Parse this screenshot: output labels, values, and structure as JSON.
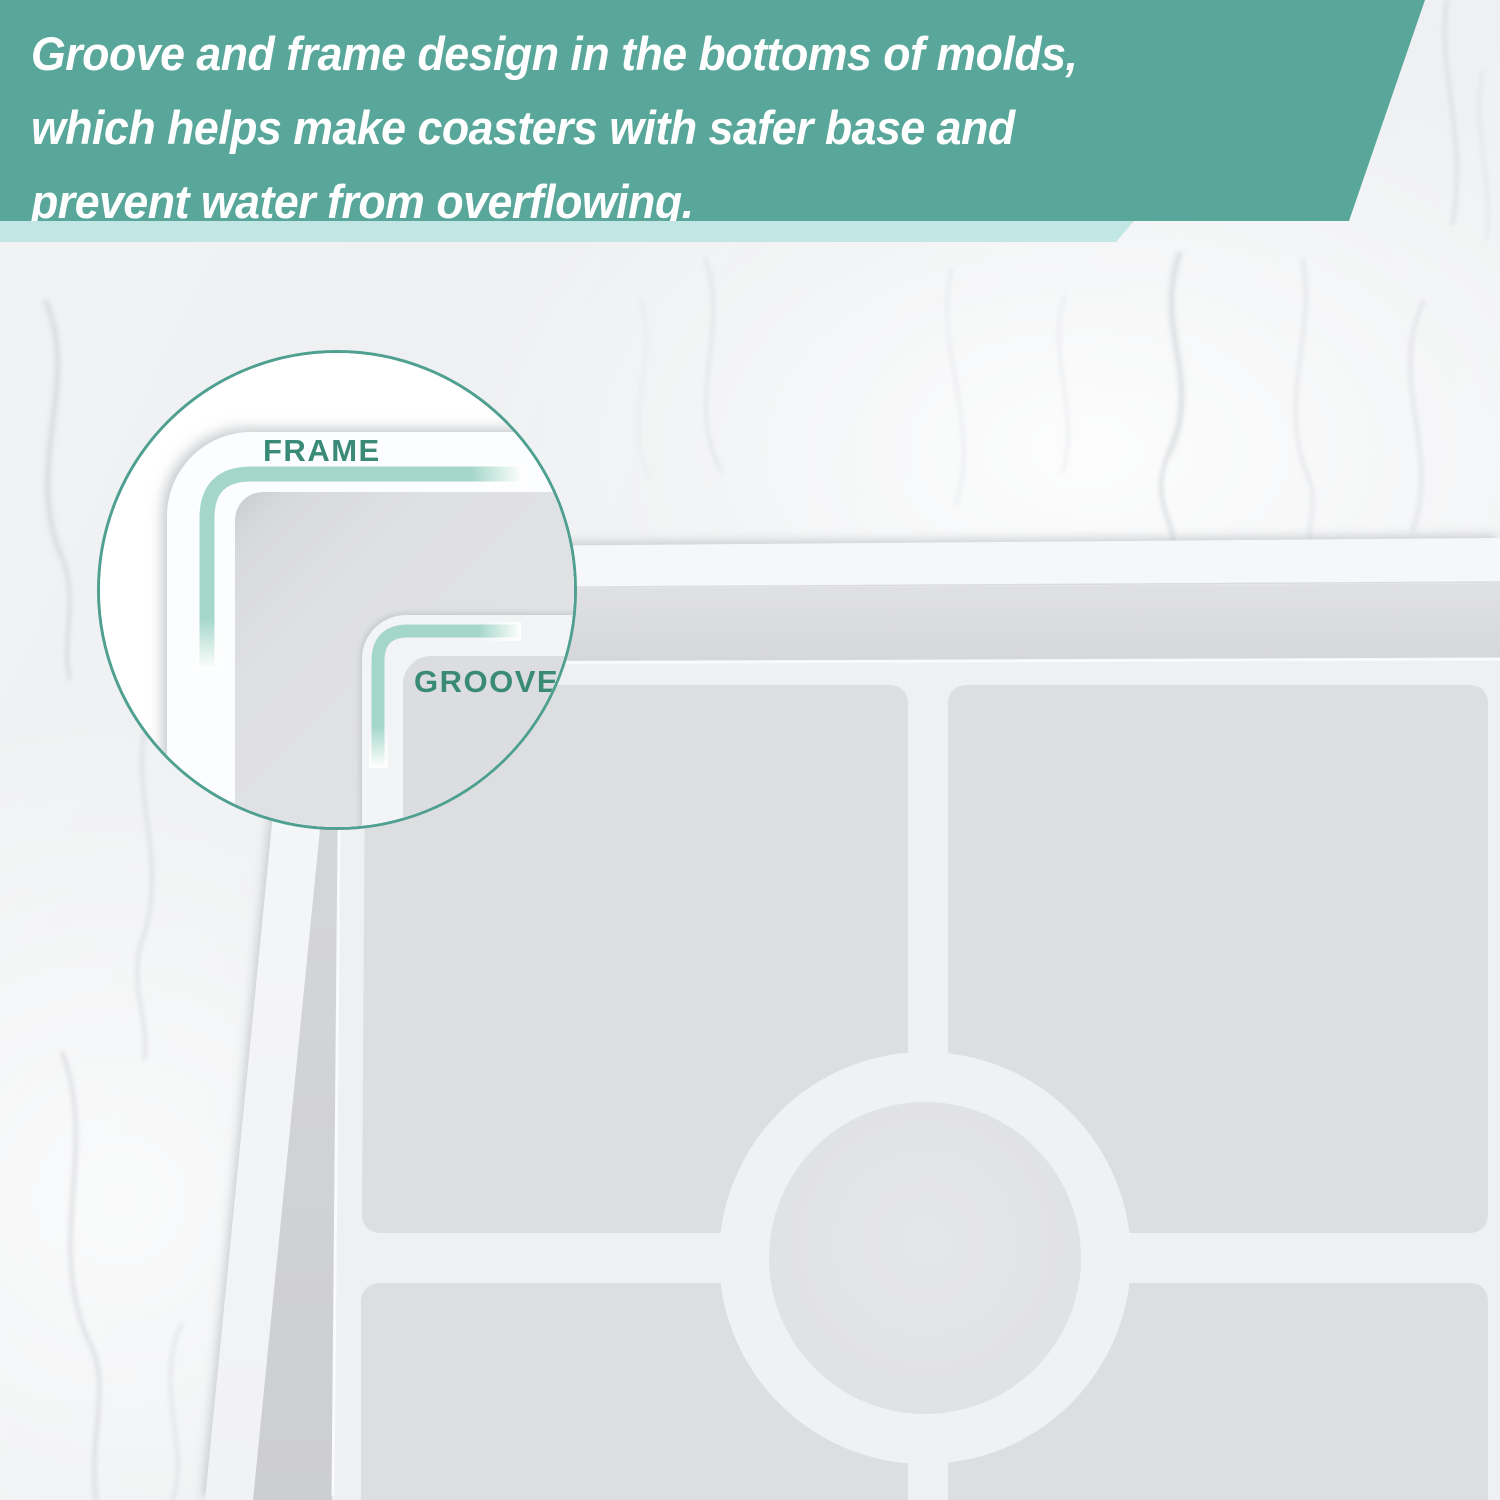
{
  "banner": {
    "lines": [
      "Groove and frame design in the bottoms of molds,",
      "which helps make coasters with safer base and",
      "prevent water from overflowing."
    ],
    "background_color": "#58A79A",
    "accent_strip_color": "#B7E3DF",
    "text_color": "#FFFFFF"
  },
  "inset": {
    "labels": {
      "frame": "FRAME",
      "groove": "GROOVE"
    },
    "label_color": "#3A8A78",
    "border_color": "#4FA090",
    "highlight_line_color": "#A5D7C9"
  },
  "mold": {
    "colors": {
      "rim": "#F4F5F7",
      "wall_top": "#E1E2E4",
      "wall_bottom": "#D3D4D7",
      "floor": "#EEF0F1",
      "cavity": "#DCDEE0",
      "ring": "#F0F1F3",
      "center_circle": "#E2E3E5"
    }
  },
  "background": {
    "marble_base": "#F1F2F3",
    "vein_color": "#C9CCD1"
  }
}
